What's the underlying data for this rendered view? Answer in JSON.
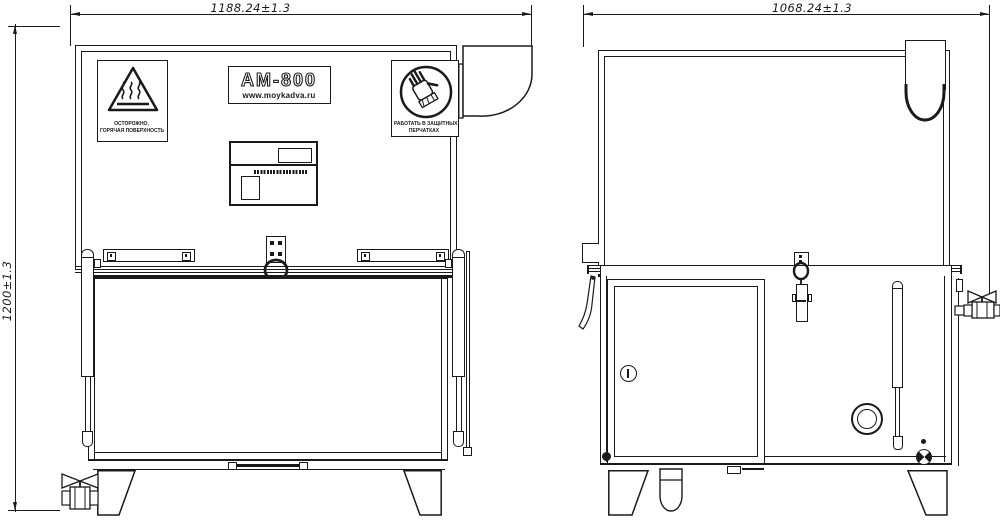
{
  "dimensions": {
    "front_width": "1188.24±1.3",
    "side_width": "1068.24±1.3",
    "height": "1200±1.3"
  },
  "nameplate": {
    "model": "АМ-800",
    "website": "www.moykadva.ru"
  },
  "warnings": {
    "hot_line1": "ОСТОРОЖНО,",
    "hot_line2": "ГОРЯЧАЯ ПОВЕРХНОСТЬ",
    "gloves_line1": "РАБОТАТЬ В ЗАЩИТНЫХ",
    "gloves_line2": "ПЕРЧАТКАХ"
  },
  "colors": {
    "line": "#1a1a1a",
    "background": "#ffffff"
  }
}
